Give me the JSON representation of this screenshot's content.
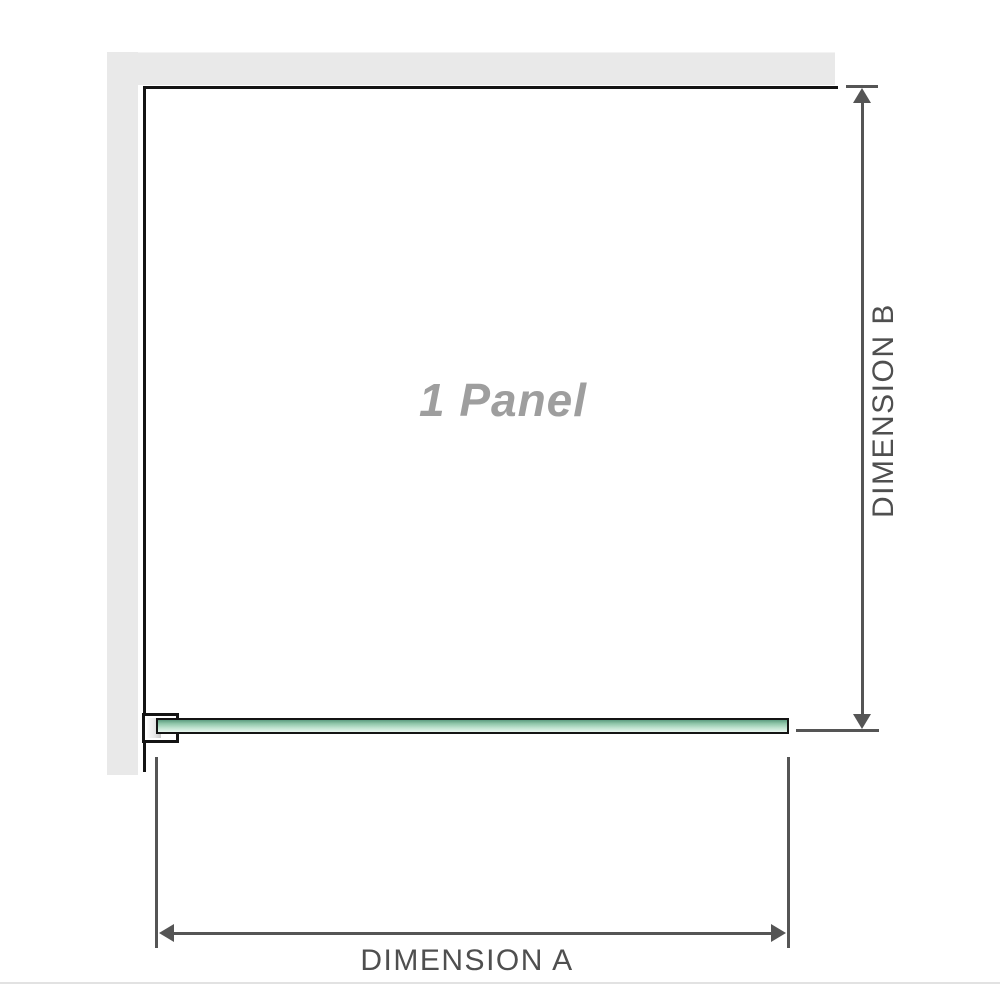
{
  "diagram": {
    "panel_label": "1 Panel",
    "dimension_a": {
      "label": "DIMENSION A"
    },
    "dimension_b": {
      "label": "DIMENSION B"
    }
  },
  "colors": {
    "wall_gray": "#e9e9e9",
    "dimension_line": "#555555",
    "outline_black": "#141414",
    "glass_green_dark": "#5d9c80",
    "glass_green_light": "#e9f6ef",
    "panel_text_gray": "#9e9e9e",
    "bottom_divider": "#e2e2e2"
  }
}
